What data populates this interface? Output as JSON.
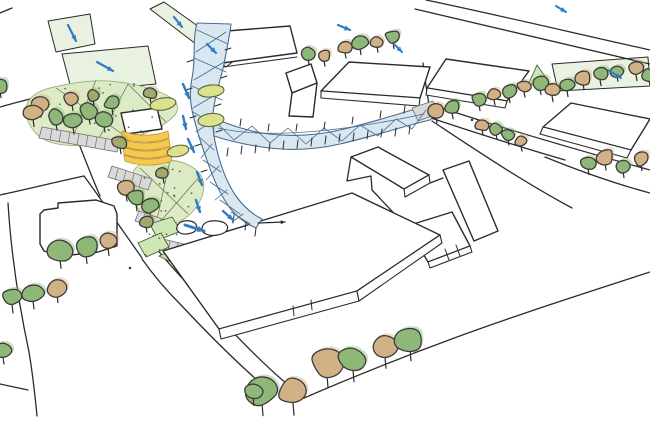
{
  "palette": {
    "ink": "#2b2b2b",
    "canopy_fill": "#d9e7f1",
    "canopy_line": "#4a6c8e",
    "water_blue": "#2e7cc2",
    "lawn": "#ddeac6",
    "strip_green": "#e9f1e0",
    "tree_green": "#8fb878",
    "tree_tan": "#d2b184",
    "tree_olive": "#a3a96c",
    "tree_yellowgreen": "#dce28c",
    "terrace_gray": "#d9d9d9",
    "building_white": "#ffffff",
    "yellow": "#f6c84f",
    "wedge_green": "#cde7b2",
    "dot_green": "#3f4a33"
  },
  "scene": {
    "trees": [
      [
        308,
        53,
        8,
        "g"
      ],
      [
        324,
        56,
        7,
        "t"
      ],
      [
        345,
        48,
        7,
        "t"
      ],
      [
        360,
        43,
        8,
        "g"
      ],
      [
        377,
        42,
        7,
        "t"
      ],
      [
        393,
        37,
        8,
        "g"
      ],
      [
        436,
        111,
        8,
        "t"
      ],
      [
        452,
        107,
        8,
        "g"
      ],
      [
        479,
        99,
        8,
        "g"
      ],
      [
        494,
        95,
        7,
        "t"
      ],
      [
        509,
        91,
        8,
        "g"
      ],
      [
        524,
        87,
        7,
        "t"
      ],
      [
        540,
        83,
        8,
        "g"
      ],
      [
        482,
        125,
        7,
        "t"
      ],
      [
        496,
        129,
        7,
        "g"
      ],
      [
        508,
        135,
        7,
        "g"
      ],
      [
        521,
        141,
        7,
        "t"
      ],
      [
        552,
        90,
        8,
        "t"
      ],
      [
        567,
        85,
        8,
        "g"
      ],
      [
        583,
        78,
        8,
        "t"
      ],
      [
        600,
        74,
        8,
        "g"
      ],
      [
        617,
        71,
        7,
        "g"
      ],
      [
        636,
        69,
        8,
        "t"
      ],
      [
        649,
        75,
        7,
        "g"
      ],
      [
        588,
        163,
        8,
        "g"
      ],
      [
        605,
        157,
        9,
        "t"
      ],
      [
        623,
        166,
        8,
        "g"
      ],
      [
        641,
        159,
        8,
        "t"
      ],
      [
        262,
        391,
        17,
        "g"
      ],
      [
        293,
        392,
        16,
        "t"
      ],
      [
        327,
        363,
        17,
        "t"
      ],
      [
        353,
        360,
        15,
        "g"
      ],
      [
        385,
        348,
        14,
        "t"
      ],
      [
        410,
        339,
        15,
        "g"
      ],
      [
        12,
        297,
        11,
        "g"
      ],
      [
        33,
        293,
        11,
        "g"
      ],
      [
        57,
        288,
        10,
        "t"
      ],
      [
        3,
        351,
        9,
        "g"
      ],
      [
        253,
        391,
        10,
        "g"
      ],
      [
        60,
        251,
        12,
        "g"
      ],
      [
        86,
        246,
        12,
        "g"
      ],
      [
        108,
        241,
        10,
        "t"
      ],
      [
        40,
        104,
        9,
        "t"
      ],
      [
        56,
        117,
        9,
        "g"
      ],
      [
        72,
        99,
        8,
        "t"
      ],
      [
        73,
        121,
        9,
        "g"
      ],
      [
        89,
        111,
        9,
        "g"
      ],
      [
        104,
        119,
        9,
        "g"
      ],
      [
        93,
        95,
        7,
        "o"
      ],
      [
        112,
        103,
        8,
        "g"
      ],
      [
        33,
        112,
        10,
        "t"
      ],
      [
        120,
        142,
        8,
        "o"
      ],
      [
        0,
        86,
        8,
        "g"
      ],
      [
        150,
        93,
        7,
        "o"
      ],
      [
        126,
        188,
        9,
        "t"
      ],
      [
        136,
        198,
        9,
        "g"
      ],
      [
        150,
        206,
        9,
        "g"
      ],
      [
        163,
        173,
        7,
        "o"
      ],
      [
        146,
        222,
        7,
        "o"
      ]
    ],
    "canopy_trees": [
      {
        "x": 163,
        "y": 104,
        "rx": 13,
        "ry": 6,
        "rot": -10
      },
      {
        "x": 211,
        "y": 91,
        "rx": 13,
        "ry": 6,
        "rot": -6
      },
      {
        "x": 211,
        "y": 120,
        "rx": 13,
        "ry": 6.5,
        "rot": -6
      },
      {
        "x": 178,
        "y": 151,
        "rx": 11,
        "ry": 5.5,
        "rot": -12
      }
    ],
    "arrows": [
      [
        68,
        25,
        76,
        41,
        2.2,
        "blue"
      ],
      [
        97,
        62,
        113,
        71,
        2.2,
        "blue"
      ],
      [
        174,
        17,
        182,
        27,
        2.2,
        "blue"
      ],
      [
        207,
        44,
        216,
        53,
        2.2,
        "blue"
      ],
      [
        338,
        25,
        350,
        30,
        2.2,
        "blue"
      ],
      [
        394,
        44,
        402,
        52,
        2.0,
        "blue"
      ],
      [
        608,
        70,
        621,
        78,
        2.0,
        "blue"
      ],
      [
        556,
        6,
        566,
        12,
        2.0,
        "blue"
      ],
      [
        183,
        84,
        189,
        98,
        2.4,
        "blue"
      ],
      [
        183,
        116,
        186,
        129,
        2.4,
        "blue"
      ],
      [
        188,
        139,
        194,
        152,
        2.4,
        "blue"
      ],
      [
        197,
        172,
        202,
        185,
        2.4,
        "blue"
      ],
      [
        196,
        200,
        200,
        212,
        2.4,
        "blue"
      ],
      [
        223,
        211,
        233,
        220,
        2.4,
        "blue"
      ],
      [
        185,
        225,
        204,
        231,
        3.0,
        "blue"
      ],
      [
        258,
        223,
        285,
        222,
        1.2,
        "ink"
      ]
    ],
    "posts": [
      [
        228,
        148,
        227,
        156
      ],
      [
        242,
        146,
        241,
        154
      ],
      [
        256,
        145,
        255,
        153
      ],
      [
        270,
        143,
        269,
        151
      ],
      [
        284,
        141,
        283,
        149
      ],
      [
        298,
        140,
        297,
        148
      ],
      [
        312,
        138,
        311,
        146
      ],
      [
        326,
        136,
        325,
        144
      ],
      [
        340,
        134,
        339,
        142
      ],
      [
        354,
        133,
        353,
        141
      ],
      [
        368,
        131,
        367,
        139
      ],
      [
        382,
        129,
        381,
        137
      ],
      [
        396,
        128,
        395,
        136
      ],
      [
        410,
        126,
        409,
        134
      ],
      [
        240,
        126,
        241,
        119
      ],
      [
        268,
        131,
        269,
        124
      ],
      [
        296,
        131,
        297,
        124
      ],
      [
        324,
        129,
        325,
        122
      ],
      [
        352,
        124,
        353,
        117
      ],
      [
        380,
        118,
        381,
        111
      ],
      [
        404,
        113,
        405,
        106
      ],
      [
        234,
        215,
        233,
        223
      ],
      [
        246,
        222,
        245,
        230
      ],
      [
        256,
        228,
        255,
        236
      ],
      [
        193,
        60,
        187,
        62
      ],
      [
        192,
        88,
        186,
        90
      ],
      [
        196,
        116,
        190,
        118
      ],
      [
        201,
        144,
        195,
        146
      ],
      [
        207,
        170,
        201,
        172
      ],
      [
        225,
        50,
        231,
        48
      ],
      [
        221,
        78,
        227,
        76
      ],
      [
        215,
        106,
        221,
        104
      ],
      [
        216,
        132,
        222,
        130
      ]
    ],
    "dot_zones": [
      {
        "x": 40,
        "y": 84,
        "w": 130,
        "h": 55,
        "n": 26,
        "seed": 3
      },
      {
        "x": 132,
        "y": 162,
        "w": 70,
        "h": 58,
        "n": 14,
        "seed": 11
      },
      {
        "x": 142,
        "y": 222,
        "w": 40,
        "h": 36,
        "n": 8,
        "seed": 21
      }
    ],
    "dots": [
      [
        472,
        120
      ],
      [
        130,
        268
      ]
    ]
  }
}
